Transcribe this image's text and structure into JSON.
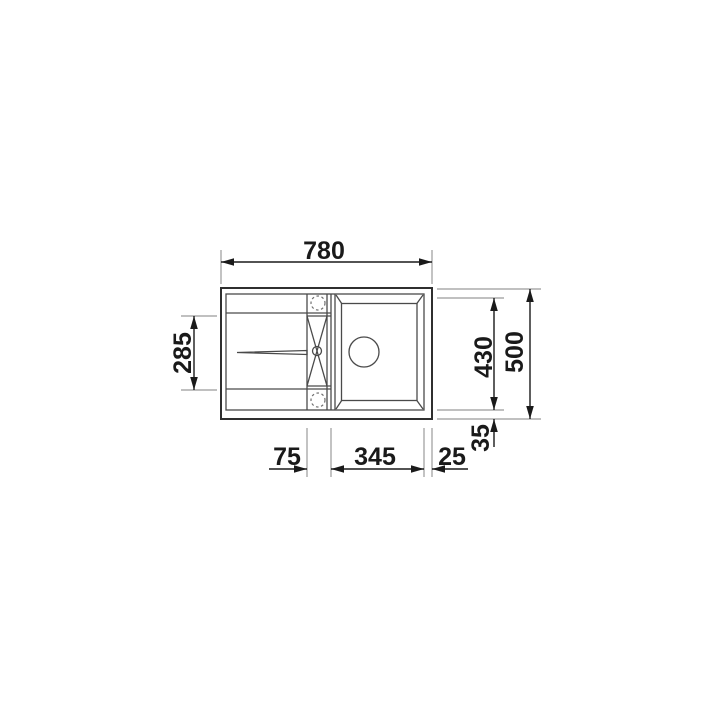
{
  "drawing": {
    "name": "kitchen-sink-top-view-technical-drawing",
    "dims": {
      "overall_width_mm": "780",
      "drainboard_length_mm": "285",
      "bowl_length_mm": "430",
      "overall_depth_mm": "500",
      "bottom_edge_mm": "35",
      "ledge_width_mm": "75",
      "bowl_width_mm": "345",
      "right_edge_mm": "25"
    },
    "colors": {
      "outline": "#2f2f2f",
      "inner_lines": "#4a4a4a",
      "dimension": "#1a1a1a",
      "extension": "#9b9b9b",
      "background": "#ffffff"
    }
  }
}
